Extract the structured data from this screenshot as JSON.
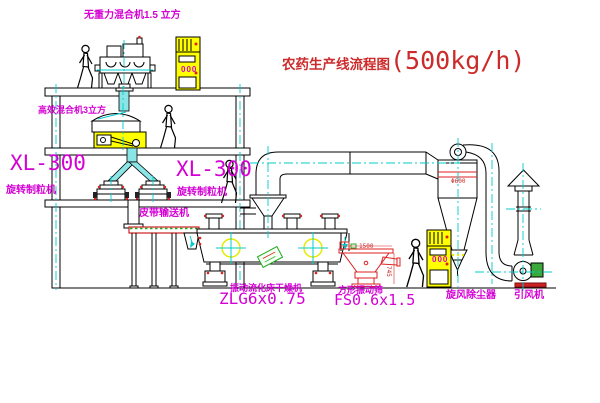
{
  "title": {
    "text": "农药生产线流程图",
    "capacity": "(500kg/h)"
  },
  "labels": {
    "mixer_top": "无重力混合机1.5 立方",
    "mixer_2f": "高效混合机3立方",
    "xl300_left": "XL-300",
    "granulator_left": "旋转制粒机",
    "xl300_right": "XL-300",
    "granulator_right": "旋转制粒机",
    "conveyor": "皮带输送机",
    "dryer": "振动流化床干燥机",
    "dryer_model": "ZLG6x0.75",
    "screen": "方形振动筛",
    "screen_model": "FS0.6x1.5",
    "cyclone": "旋风除尘器",
    "fan": "引风机"
  },
  "dimensions": {
    "cyclone_dia": "Φ600",
    "screen_len": "1500",
    "screen_h": "745"
  },
  "cabinets": {
    "c1_display": "000",
    "c2_display": "000"
  },
  "colors": {
    "label_magenta": "#d400d4",
    "title_red": "#cc2b2b",
    "centerline_cyan": "#00cccc",
    "cabinet_yellow": "#ffff00",
    "accent_red": "#dd2222",
    "accent_green": "#22aa22",
    "chute_cyan": "#8ae6e6"
  }
}
